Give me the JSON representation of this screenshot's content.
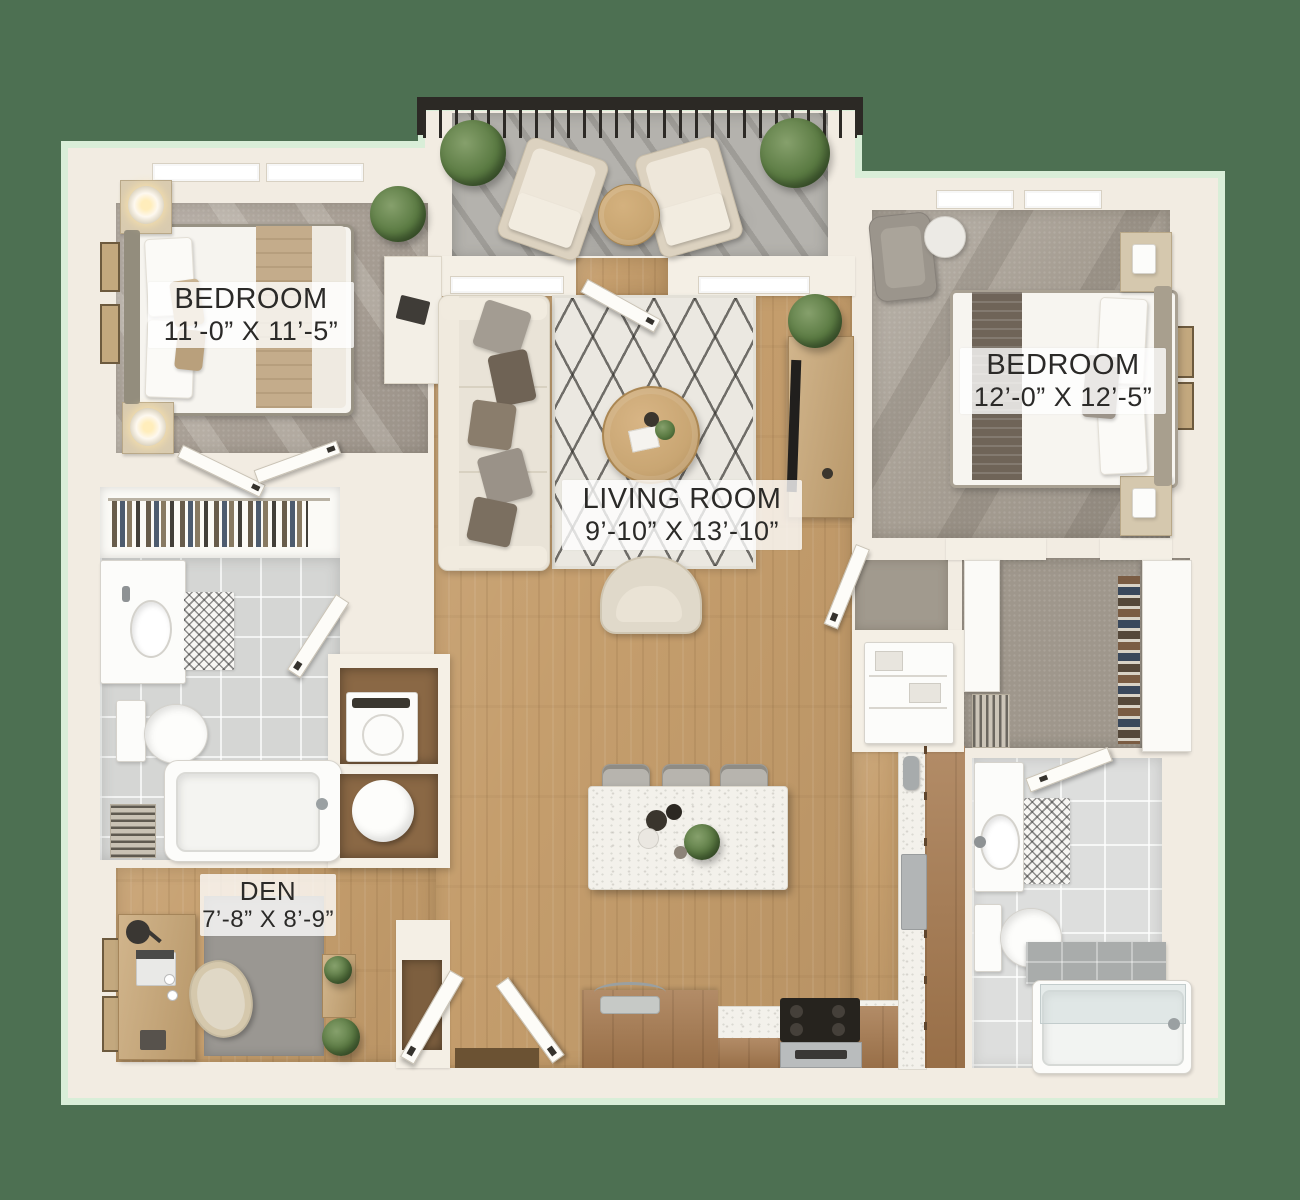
{
  "plan": {
    "type": "apartment-floor-plan-3d-render",
    "rooms": [
      {
        "id": "bedroom-1",
        "label": "BEDROOM",
        "dims": "11’-0” X 11’-5”"
      },
      {
        "id": "bedroom-2",
        "label": "BEDROOM",
        "dims": "12’-0” X 12’-5”"
      },
      {
        "id": "living-room",
        "label": "LIVING ROOM",
        "dims": "9’-10” X 13’-10”"
      },
      {
        "id": "den",
        "label": "DEN",
        "dims": "7’-8” X 8’-9”"
      }
    ],
    "palette": {
      "background": "#4d7052",
      "halo": "#d9eed8",
      "wall": "#f2ece2",
      "wood_floor": "#c59e6d",
      "carpet": "#a9a096",
      "tile": "#d5d6d4",
      "cabinet": "#a87c52",
      "rug": "#ebe8e1",
      "plant_green": "#5a7a42",
      "railing": "#2c2925",
      "label_text": "#2b2a28"
    }
  }
}
